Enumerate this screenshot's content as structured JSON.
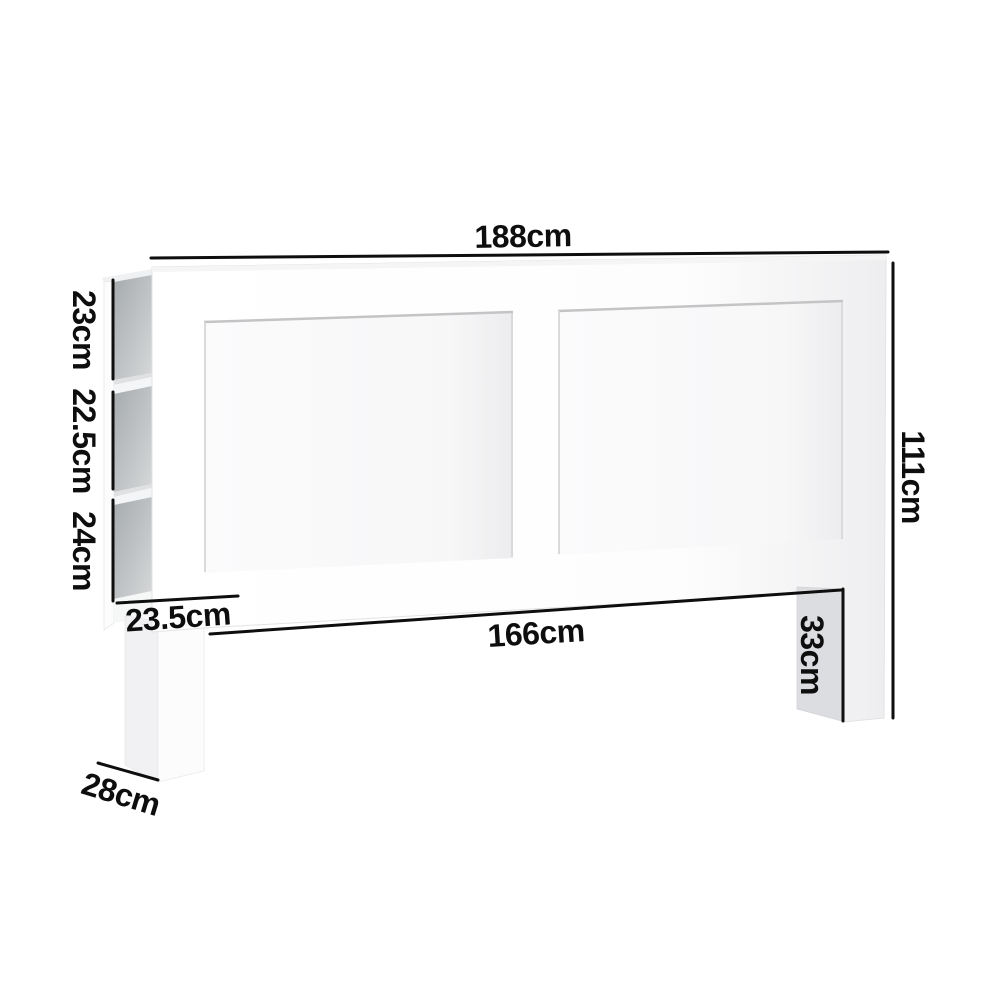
{
  "diagram": {
    "labels": {
      "overall_width": "188cm",
      "overall_height": "111cm",
      "bottom_edge_width": "166cm",
      "shelf_opening_top": "23cm",
      "shelf_opening_middle": "22.5cm",
      "shelf_opening_bottom": "24cm",
      "shelf_depth": "23.5cm",
      "leg_height": "33cm",
      "base_depth": "28cm"
    },
    "colors": {
      "background": "#ffffff",
      "dimension_line": "#0e0e0e",
      "label_text": "#0e0e0e",
      "furniture_face": "#ffffff",
      "furniture_shade": "#ededef",
      "shelf_interior_dark": "#a6abae",
      "shelf_interior_light": "#d6d8d9",
      "leg_side_panel": "#dcdde0"
    }
  }
}
